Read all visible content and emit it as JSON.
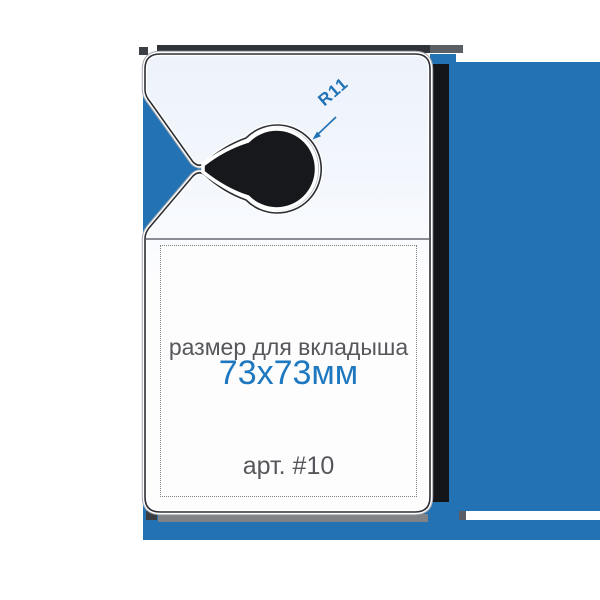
{
  "diagram": {
    "radius_label": "R11",
    "insert_caption": "размер для вкладыша",
    "insert_size": "73х73мм",
    "article_number": "арт. #10"
  },
  "colors": {
    "panel_blue": "#2272b4",
    "accent_blue": "#2273b5",
    "value_blue": "#1e78bf",
    "caption_gray": "#55575b",
    "card_outline": "#2c2f34",
    "card_fill_top": "#edf2fb",
    "keyhole_black": "#17181b",
    "shadow_dark": "#131519",
    "shadow_gray": "#7f8287",
    "dotted_border_gray": "#7d8085"
  }
}
